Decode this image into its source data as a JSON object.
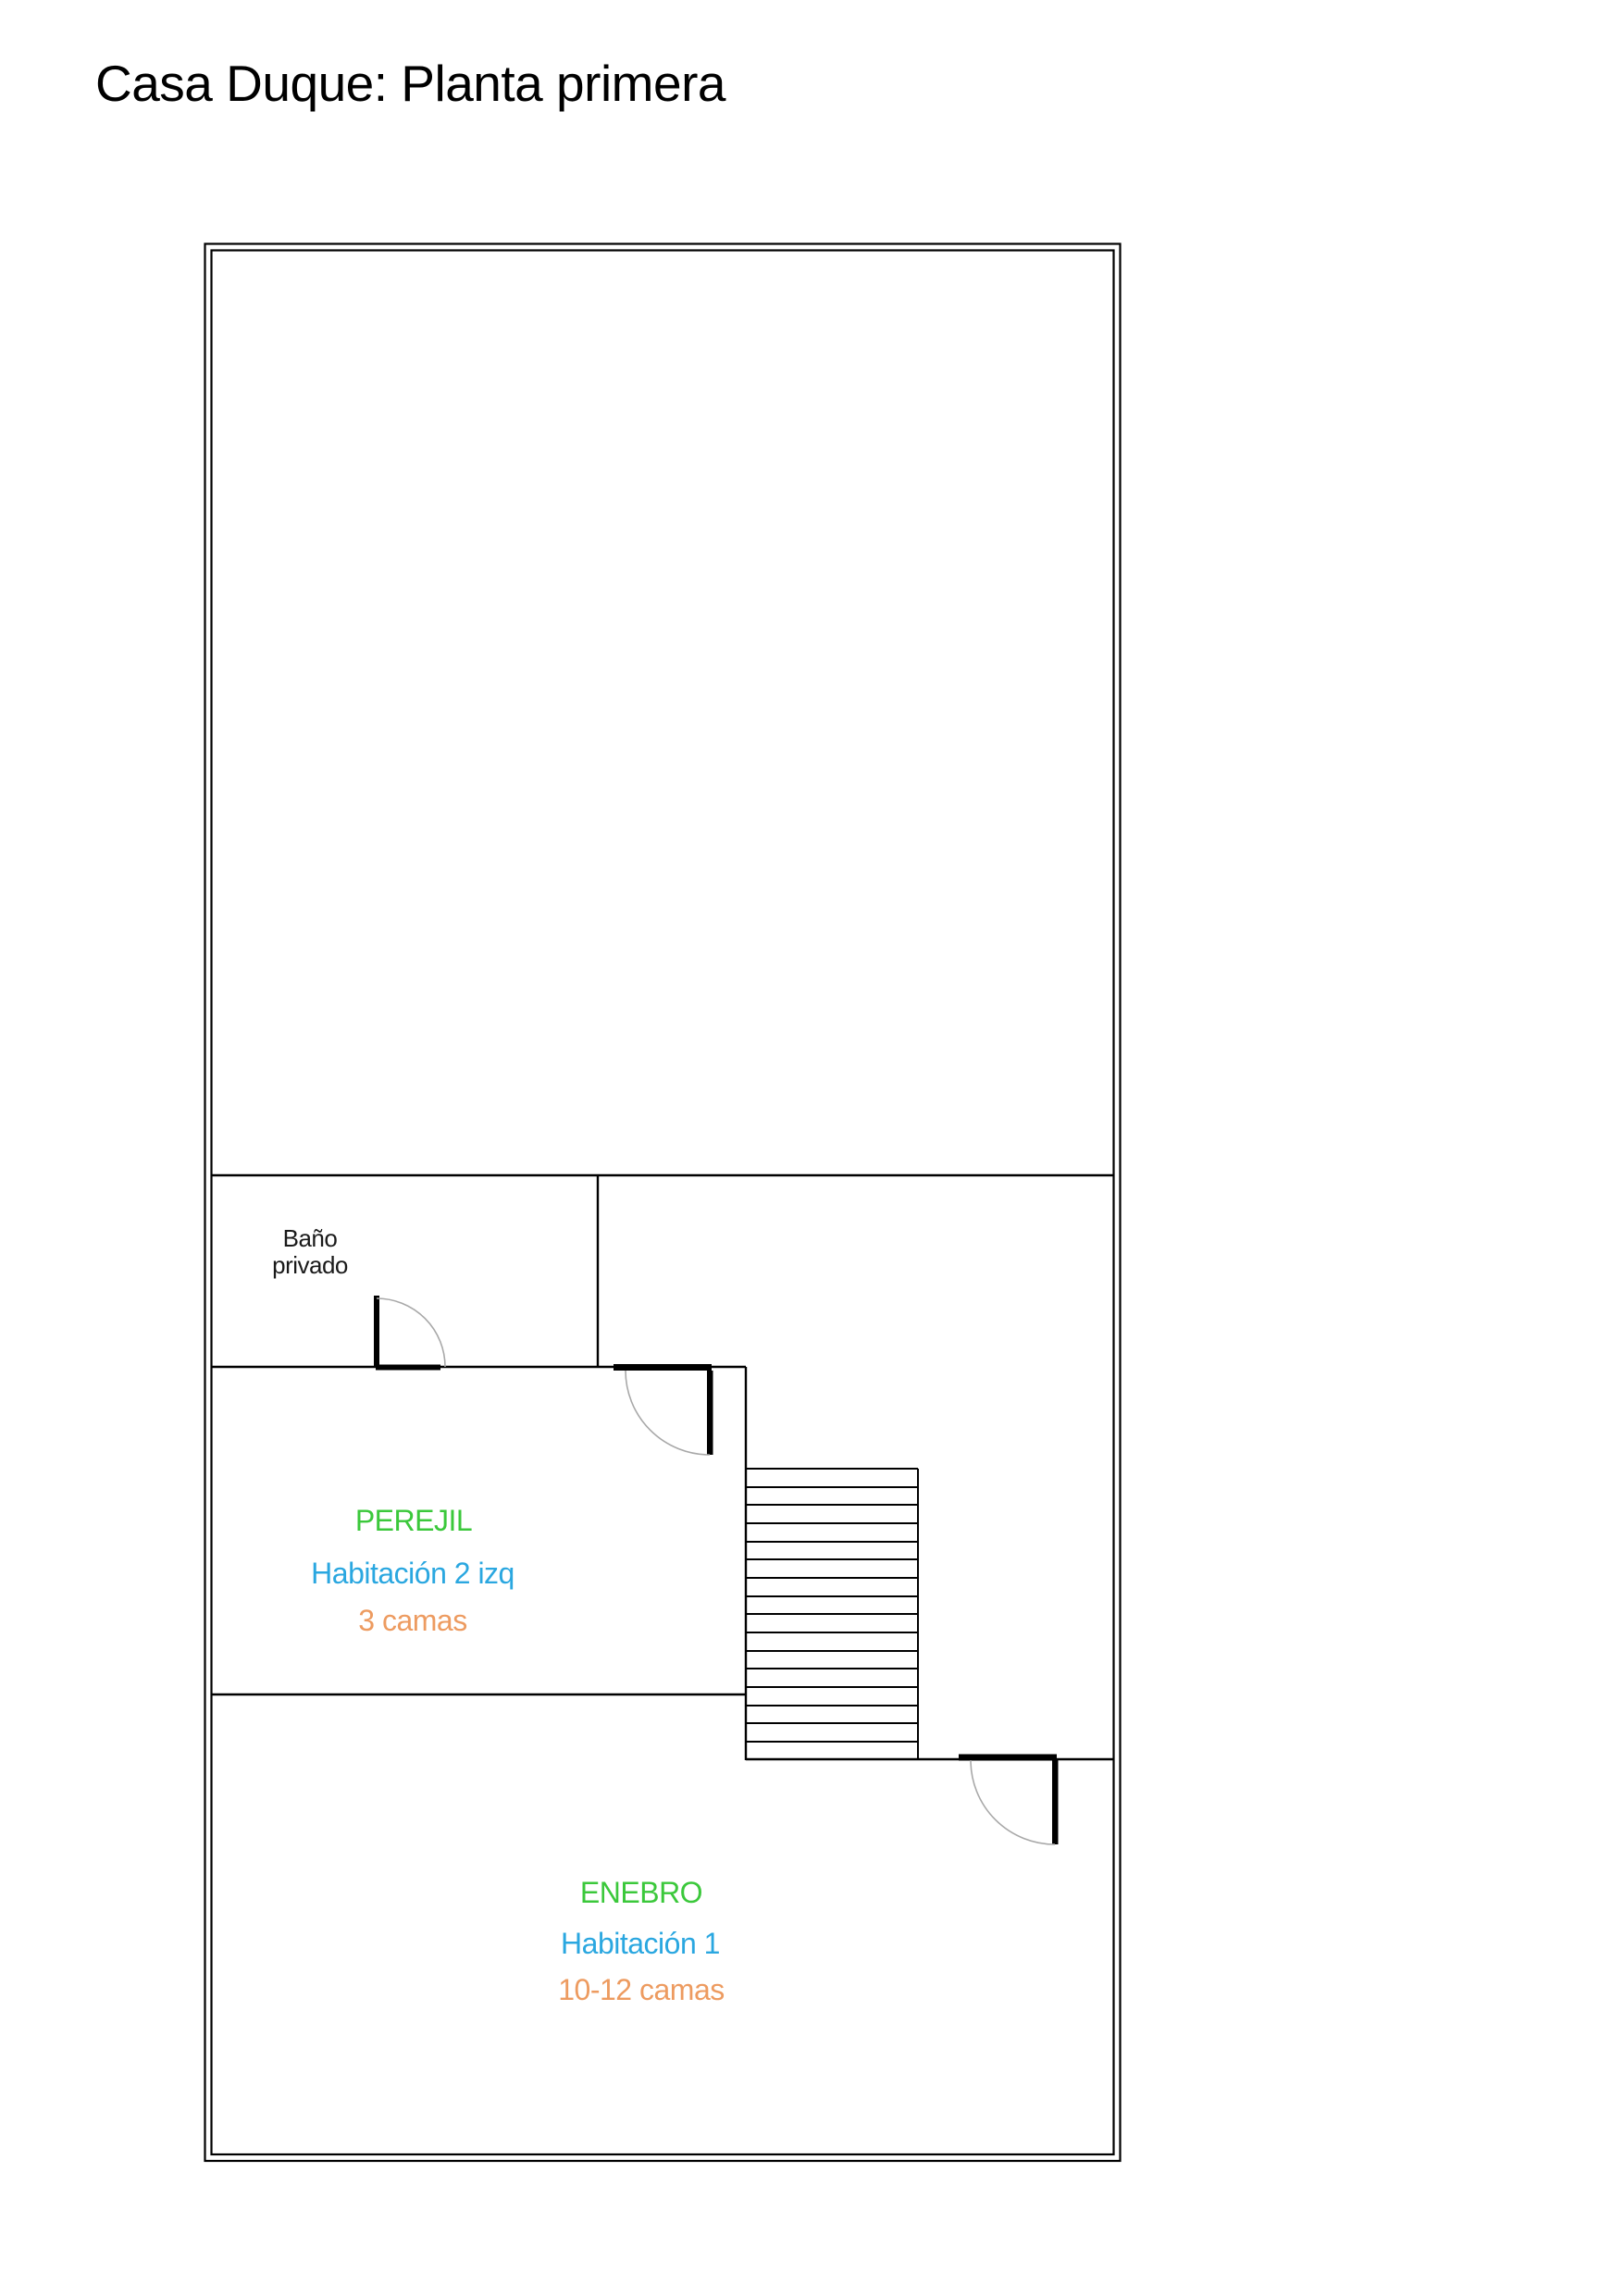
{
  "page": {
    "title": "Casa Duque: Planta primera"
  },
  "colors": {
    "room_name": "#3bc83b",
    "room_number": "#2aa7e0",
    "beds": "#ed9b60",
    "walls": "#000000",
    "door_arc": "#a8a8a8"
  },
  "floor_plan": {
    "bathroom": {
      "label_line1": "Baño",
      "label_line2": "privado"
    },
    "room_perejil": {
      "name": "PEREJIL",
      "number": "Habitación 2 izq",
      "beds": "3 camas"
    },
    "room_enebro": {
      "name": "ENEBRO",
      "number": "Habitación 1",
      "beds": "10-12 camas"
    }
  }
}
